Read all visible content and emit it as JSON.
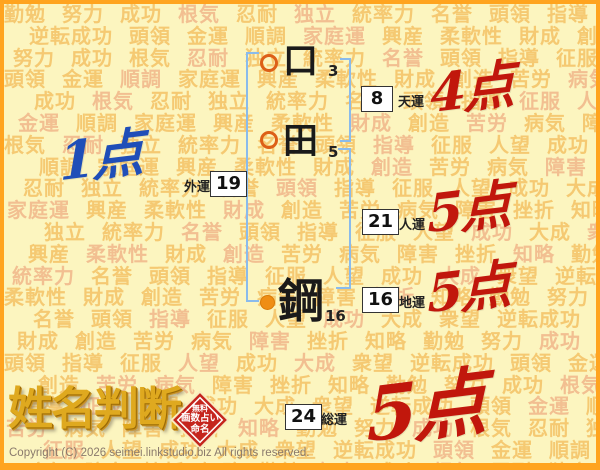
{
  "page": {
    "copyright": "Copyright (C) 2026 seimei.linkstudio.biz All rights reserved."
  },
  "logo": {
    "title": "姓名判断",
    "stamp_lines": [
      "無料",
      "画数占い",
      "命名"
    ]
  },
  "name": {
    "surname": [
      {
        "char": "口",
        "strokes": "3"
      },
      {
        "char": "田",
        "strokes": "5"
      }
    ],
    "given": [
      {
        "char": "鋼",
        "strokes": "16"
      }
    ]
  },
  "results": [
    {
      "label": "天運",
      "value": "8",
      "score": "4点",
      "score_color": "red"
    },
    {
      "label": "外運",
      "value": "19",
      "score": "1点",
      "score_color": "blue"
    },
    {
      "label": "人運",
      "value": "21",
      "score": "5点",
      "score_color": "red"
    },
    {
      "label": "地運",
      "value": "16",
      "score": "5点",
      "score_color": "red"
    },
    {
      "label": "総運",
      "value": "24",
      "score": "5点",
      "score_color": "red"
    }
  ],
  "icons": {
    "surname_marker": "ring-circle-icon",
    "given_marker": "filled-circle-icon"
  },
  "colors": {
    "frame_border": "#FFA41F",
    "background": "#FCF5BF",
    "bg_word_primary": "#F3BE5F",
    "bg_word_secondary": "#EEA87D",
    "bracket_blue": "#8ABBEC",
    "ring_orange": "#DD5F17",
    "dot_orange": "#EF8E15",
    "score_red": "#C1170C",
    "score_blue": "#1F4EB8",
    "stamp_red": "#C5251D",
    "logo_gold": "#DFA91F"
  },
  "background": {
    "words": [
      "勤勉",
      "努力",
      "成功",
      "根気",
      "忍耐",
      "独立",
      "統率力",
      "名誉",
      "頭領",
      "指導",
      "征服",
      "人望",
      "成功",
      "大成",
      "衆望",
      "逆転成功",
      "頭領",
      "金運",
      "順調",
      "家庭運",
      "興産",
      "柔軟性",
      "財成",
      "創造",
      "苦労",
      "病気",
      "障害",
      "挫折",
      "知略"
    ]
  }
}
